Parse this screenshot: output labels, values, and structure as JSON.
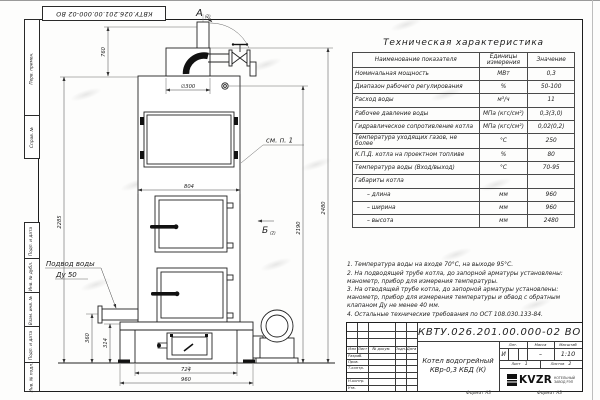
{
  "sheet": {
    "doc_number_top": "КВТУ.026.201.00.000-02  ВО",
    "bottom_labels": [
      "Формат А3",
      "Формат А3"
    ]
  },
  "margin_labels": [
    "Перв. примен.",
    "Справ. №",
    "Подп. и дата",
    "Инв. № дубл.",
    "Взам. инв. №",
    "Подп. и дата",
    "Инв. № подл."
  ],
  "table": {
    "title": "Техническая характеристика",
    "headers": [
      "Наименование показателя",
      "Единицы измерения",
      "Значение"
    ],
    "rows": [
      [
        "Номинальная мощность",
        "МВт",
        "0,3"
      ],
      [
        "Диапазон рабочего регулирования",
        "%",
        "50-100"
      ],
      [
        "Расход воды",
        "м³/ч",
        "11"
      ],
      [
        "Рабочее давление воды",
        "МПа (кгс/см²)",
        "0,3(3,0)"
      ],
      [
        "Гидравлическое сопротивление котла",
        "МПа (кгс/см²)",
        "0,02(0,2)"
      ],
      [
        "Температура уходящих газов, не более",
        "°С",
        "250"
      ],
      [
        "К.П.Д. котла на проектном топливе",
        "%",
        "80"
      ],
      [
        "Температура воды (Вход/выход)",
        "°С",
        "70-95"
      ],
      [
        "Габариты котла",
        "",
        ""
      ],
      [
        "– длина",
        "мм",
        "960"
      ],
      [
        "– ширина",
        "мм",
        "960"
      ],
      [
        "– высота",
        "мм",
        "2480"
      ]
    ]
  },
  "notes": {
    "items": [
      "1.   Температура воды на входе 70°С, на выходе 95°С.",
      "2.   На подводящей трубе котла, до запорной арматуры установлены: манометр, прибор для измерения температуры.",
      "3.   На отводящей трубе котла, до запорной арматуры установлены: манометр, прибор для измерения температуры и обвод с обратным клапаном Ду не менее 40 мм.",
      "4.   Остальные технические требования по ОСТ 108.030.133-84."
    ]
  },
  "title_block": {
    "doc_number": "КВТУ.026.201.00.000-02  ВО",
    "product_line1": "Котел водогрейный",
    "product_line2": "КВр-0,3  КБД  (К)",
    "header_cols": [
      "Изм",
      "Лист",
      "№ докум.",
      "Подп.",
      "Дата"
    ],
    "row_labels": [
      "Разраб.",
      "Пров.",
      "Т.контр.",
      "Н.контр.",
      "Утв."
    ],
    "lit_label": "Лит.",
    "mass_label": "Масса",
    "scale_label": "Масштаб",
    "lit_value": "И",
    "mass_value": "–",
    "scale_value": "1:10",
    "sheet_label": "Лист",
    "sheet_value": "1",
    "sheets_label": "Листов",
    "sheets_value": "2",
    "logo_text": "KVZR",
    "logo_caption1": "КОТЕЛЬНЫЙ",
    "logo_caption2": "ЗАВОД РЭП"
  },
  "drawing": {
    "view_a": "А",
    "view_a_sub": "(2)",
    "view_b": "Б",
    "view_b_sub": "(2)",
    "callout": "см. п. 1",
    "water_line1": "Подвод воды",
    "water_line2": "Ду 50",
    "dims": {
      "d300": "∅300",
      "h760": "760",
      "w804": "804",
      "h2285": "2285",
      "h2190": "2190",
      "h2480": "2480",
      "h360": "360",
      "h314": "314",
      "w724": "724",
      "w960": "960"
    }
  }
}
